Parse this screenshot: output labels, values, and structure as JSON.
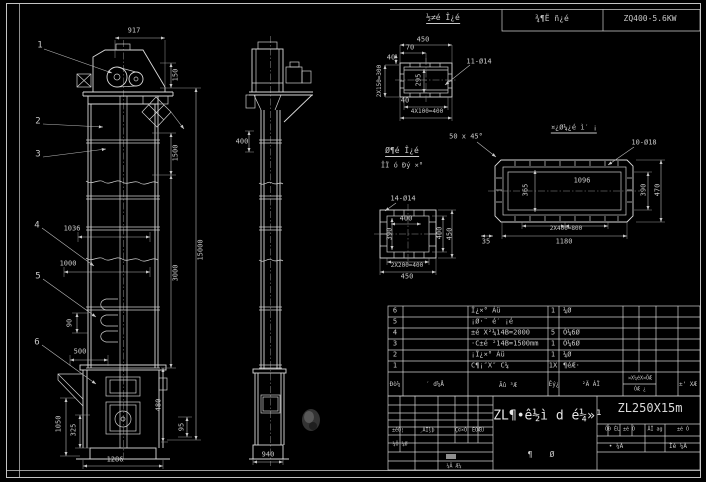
{
  "sheet": {
    "width": 706,
    "height": 482,
    "model": "ZL250X15m",
    "drive_unit": "ZQ400-5.6KW"
  },
  "colors": {
    "background": "#000000",
    "line": "#d9d9d9",
    "dim_line": "#b9b9b9",
    "text": "#c9c9c9",
    "accent_text": "#e6e6e6",
    "signature_mark": "#8f8f8f"
  },
  "annotations": [
    {
      "n": "strip-note",
      "t": "½≠é Î¿é",
      "x": 443,
      "y": 19,
      "s": 8,
      "u": 1
    },
    {
      "n": "strip-drive-label",
      "t": "¾¶Ë ñ¿é",
      "x": 552,
      "y": 19,
      "s": 8
    },
    {
      "n": "strip-drive-model",
      "t": "ZQ400-5.6KW",
      "x": 650,
      "y": 19,
      "s": 8
    },
    {
      "n": "balloon-1",
      "t": "1",
      "x": 40,
      "y": 46,
      "s": 9
    },
    {
      "n": "balloon-2",
      "t": "2",
      "x": 38,
      "y": 122,
      "s": 9
    },
    {
      "n": "balloon-3",
      "t": "3",
      "x": 38,
      "y": 155,
      "s": 9
    },
    {
      "n": "balloon-4",
      "t": "4",
      "x": 37,
      "y": 226,
      "s": 9
    },
    {
      "n": "balloon-5",
      "t": "5",
      "x": 38,
      "y": 277,
      "s": 9
    },
    {
      "n": "balloon-6",
      "t": "6",
      "x": 37,
      "y": 343,
      "s": 9
    },
    {
      "n": "dim-917",
      "t": "917",
      "x": 134,
      "y": 31
    },
    {
      "n": "dim-150",
      "t": "150",
      "x": 176,
      "y": 75,
      "r": -90
    },
    {
      "n": "dim-1500",
      "t": "1500",
      "x": 176,
      "y": 153,
      "r": -90
    },
    {
      "n": "dim-3000",
      "t": "3000",
      "x": 176,
      "y": 273,
      "r": -90
    },
    {
      "n": "dim-15000",
      "t": "15000",
      "x": 201,
      "y": 250,
      "r": -90
    },
    {
      "n": "dim-480",
      "t": "480",
      "x": 159,
      "y": 405,
      "r": -90
    },
    {
      "n": "dim-95",
      "t": "95",
      "x": 182,
      "y": 427,
      "r": -90
    },
    {
      "n": "dim-1036",
      "t": "1036",
      "x": 72,
      "y": 229
    },
    {
      "n": "dim-1000",
      "t": "1000",
      "x": 68,
      "y": 264
    },
    {
      "n": "dim-90",
      "t": "90",
      "x": 70,
      "y": 323,
      "r": -90
    },
    {
      "n": "dim-500",
      "t": "500",
      "x": 80,
      "y": 352
    },
    {
      "n": "dim-1050",
      "t": "1050",
      "x": 59,
      "y": 424,
      "r": -90
    },
    {
      "n": "dim-325",
      "t": "325",
      "x": 74,
      "y": 430,
      "r": -90
    },
    {
      "n": "dim-1286",
      "t": "1286",
      "x": 115,
      "y": 460
    },
    {
      "n": "dim-400-side",
      "t": "400",
      "x": 242,
      "y": 142
    },
    {
      "n": "dim-940",
      "t": "940",
      "x": 268,
      "y": 455
    },
    {
      "n": "dim-450-top",
      "t": "450",
      "x": 423,
      "y": 40
    },
    {
      "n": "dim-70",
      "t": "70",
      "x": 410,
      "y": 48
    },
    {
      "n": "dim-40a",
      "t": "40",
      "x": 391,
      "y": 58
    },
    {
      "n": "dim-2x150",
      "t": "2X150=300",
      "x": 380,
      "y": 81,
      "r": -90,
      "s": 6
    },
    {
      "n": "dim-295",
      "t": "295",
      "x": 419,
      "y": 80,
      "r": -90
    },
    {
      "n": "callout-11-d14",
      "t": "11-Ø14",
      "x": 479,
      "y": 62
    },
    {
      "n": "dim-4x100",
      "t": "4X100=400",
      "x": 427,
      "y": 112,
      "s": 6
    },
    {
      "n": "dim-40b",
      "t": "40",
      "x": 405,
      "y": 101
    },
    {
      "n": "note-detail-title",
      "t": "Ø¶é Î¿é",
      "x": 402,
      "y": 152,
      "s": 8,
      "u": 1
    },
    {
      "n": "note-detail-sub",
      "t": "ÎÏ ó Ðý ×°",
      "x": 402,
      "y": 166,
      "s": 7
    },
    {
      "n": "callout-14-d14",
      "t": "14-Ø14",
      "x": 403,
      "y": 199
    },
    {
      "n": "dim-400-inner",
      "t": "400",
      "x": 406,
      "y": 219
    },
    {
      "n": "dim-390-inner",
      "t": "390",
      "x": 390,
      "y": 234,
      "r": -90
    },
    {
      "n": "dim-400-right",
      "t": "400",
      "x": 440,
      "y": 233,
      "r": -90
    },
    {
      "n": "dim-450-right",
      "t": "450",
      "x": 450,
      "y": 234,
      "r": -90
    },
    {
      "n": "dim-2x200",
      "t": "2X200=400",
      "x": 407,
      "y": 266,
      "s": 6
    },
    {
      "n": "dim-450-bottom",
      "t": "450",
      "x": 407,
      "y": 277
    },
    {
      "n": "note-chamfer",
      "t": "50 x 45°",
      "x": 466,
      "y": 137
    },
    {
      "n": "note-casing",
      "t": "¤¿Ø¼¿é ì′ ¡",
      "x": 574,
      "y": 129,
      "s": 7,
      "u": 1
    },
    {
      "n": "callout-10-d18",
      "t": "10-Ø18",
      "x": 644,
      "y": 143
    },
    {
      "n": "dim-1096",
      "t": "1096",
      "x": 582,
      "y": 181
    },
    {
      "n": "dim-365",
      "t": "365",
      "x": 526,
      "y": 190,
      "r": -90
    },
    {
      "n": "dim-390-casing",
      "t": "390",
      "x": 644,
      "y": 190,
      "r": -90
    },
    {
      "n": "dim-470",
      "t": "470",
      "x": 658,
      "y": 190,
      "r": -90
    },
    {
      "n": "dim-2x400",
      "t": "2X400=800",
      "x": 566,
      "y": 229,
      "s": 6
    },
    {
      "n": "dim-1180",
      "t": "1180",
      "x": 564,
      "y": 242
    },
    {
      "n": "dim-35",
      "t": "35",
      "x": 486,
      "y": 242
    },
    {
      "n": "bom-row6-no",
      "t": "6",
      "x": 395,
      "y": 311
    },
    {
      "n": "bom-row6-name",
      "t": "Î¿×° Àü",
      "x": 471,
      "y": 311,
      "a": "l"
    },
    {
      "n": "bom-row6-qty",
      "t": "1",
      "x": 553,
      "y": 311
    },
    {
      "n": "bom-row6-mat",
      "t": "¼Ø",
      "x": 563,
      "y": 311,
      "a": "l"
    },
    {
      "n": "bom-row5-no",
      "t": "5",
      "x": 395,
      "y": 322
    },
    {
      "n": "bom-row5-name",
      "t": "¡Ø·¨ é′ ¡é",
      "x": 471,
      "y": 322,
      "a": "l"
    },
    {
      "n": "bom-row4-no",
      "t": "4",
      "x": 395,
      "y": 333
    },
    {
      "n": "bom-row4-name",
      "t": "±é X²¼14B=2000",
      "x": 471,
      "y": 333,
      "a": "l"
    },
    {
      "n": "bom-row4-qty",
      "t": "5",
      "x": 553,
      "y": 333
    },
    {
      "n": "bom-row4-mat",
      "t": "Ò¼6Ø",
      "x": 563,
      "y": 333,
      "a": "l"
    },
    {
      "n": "bom-row3-no",
      "t": "3",
      "x": 395,
      "y": 344
    },
    {
      "n": "bom-row3-name",
      "t": "·C±é ²14B=1500mm",
      "x": 471,
      "y": 344,
      "a": "l"
    },
    {
      "n": "bom-row3-qty",
      "t": "1",
      "x": 553,
      "y": 344
    },
    {
      "n": "bom-row3-mat",
      "t": "Ò¼6Ø",
      "x": 563,
      "y": 344,
      "a": "l"
    },
    {
      "n": "bom-row2-no",
      "t": "2",
      "x": 395,
      "y": 355
    },
    {
      "n": "bom-row2-name",
      "t": "¡Î¿×° Àü",
      "x": 471,
      "y": 355,
      "a": "l"
    },
    {
      "n": "bom-row2-qty",
      "t": "1",
      "x": 553,
      "y": 355
    },
    {
      "n": "bom-row2-mat",
      "t": "¼Ø",
      "x": 563,
      "y": 355,
      "a": "l"
    },
    {
      "n": "bom-row1-no",
      "t": "1",
      "x": 395,
      "y": 366
    },
    {
      "n": "bom-row1-name",
      "t": "C¶¡″X″ C¼",
      "x": 471,
      "y": 366,
      "a": "l"
    },
    {
      "n": "bom-row1-qty",
      "t": "1X",
      "x": 553,
      "y": 366
    },
    {
      "n": "bom-row1-mat",
      "t": "¶éÆ·",
      "x": 563,
      "y": 366,
      "a": "l"
    },
    {
      "n": "bom-header-seq",
      "t": "Ðò¼",
      "x": 395,
      "y": 385,
      "s": 6
    },
    {
      "n": "bom-header-code",
      "t": "′ d¼Å",
      "x": 435,
      "y": 385,
      "s": 6
    },
    {
      "n": "bom-header-name",
      "t": "Ãû ³Æ",
      "x": 508,
      "y": 386,
      "s": 6
    },
    {
      "n": "bom-header-qty",
      "t": "Êý¿",
      "x": 554,
      "y": 385,
      "s": 6
    },
    {
      "n": "bom-header-mat",
      "t": "²Ä ÁÏ",
      "x": 591,
      "y": 385,
      "s": 6
    },
    {
      "n": "bom-header-note-top",
      "t": "¤X¼éX¤ÖÆ",
      "x": 640,
      "y": 379,
      "s": 5
    },
    {
      "n": "bom-header-note-bot",
      "t": "ÓÆ ¿",
      "x": 640,
      "y": 390,
      "s": 5
    },
    {
      "n": "bom-header-remark",
      "t": "±' XÆ",
      "x": 688,
      "y": 385,
      "s": 6
    },
    {
      "n": "drawing-title",
      "t": "ZL¶•ê½ì d é¼»¹",
      "x": 548,
      "y": 416,
      "s": 13,
      "c": "#e6e6e6"
    },
    {
      "n": "model-number",
      "t": "ZL250X15m",
      "x": 650,
      "y": 408,
      "s": 12,
      "c": "#d9d9d9"
    },
    {
      "n": "sheet-count-a",
      "t": "¶",
      "x": 530,
      "y": 455,
      "s": 8
    },
    {
      "n": "sheet-count-b",
      "t": "Ø",
      "x": 552,
      "y": 455,
      "s": 8
    },
    {
      "n": "tb-label-mark",
      "t": "±êÖ¦",
      "x": 398,
      "y": 431,
      "s": 5
    },
    {
      "n": "tb-label-docs",
      "t": "¸ÄÎļþ",
      "x": 427,
      "y": 431,
      "s": 5
    },
    {
      "n": "tb-label-sign",
      "t": "Ç©×Ó",
      "x": 461,
      "y": 431,
      "s": 5
    },
    {
      "n": "tb-label-date",
      "t": "ÈÕÆÚ",
      "x": 478,
      "y": 431,
      "s": 5
    },
    {
      "n": "tb-label-design",
      "t": "¼Õ ¼Ø",
      "x": 400,
      "y": 445,
      "s": 5
    },
    {
      "n": "tb-label-check",
      "t": "¼Ä Æ¼",
      "x": 454,
      "y": 467,
      "s": 5
    },
    {
      "n": "tb-right-a",
      "t": "ÖÐ ÈL ±é Ó",
      "x": 620,
      "y": 430,
      "s": 5
    },
    {
      "n": "tb-right-b",
      "t": "ÅÎ ag",
      "x": 655,
      "y": 430,
      "s": 5
    },
    {
      "n": "tb-right-c",
      "t": "±é Ó",
      "x": 683,
      "y": 430,
      "s": 5
    },
    {
      "n": "tb-right-d",
      "t": "• ¼Ä",
      "x": 616,
      "y": 447,
      "s": 6
    },
    {
      "n": "tb-right-e",
      "t": "Ìé ¼Ä",
      "x": 678,
      "y": 447,
      "s": 6
    }
  ]
}
